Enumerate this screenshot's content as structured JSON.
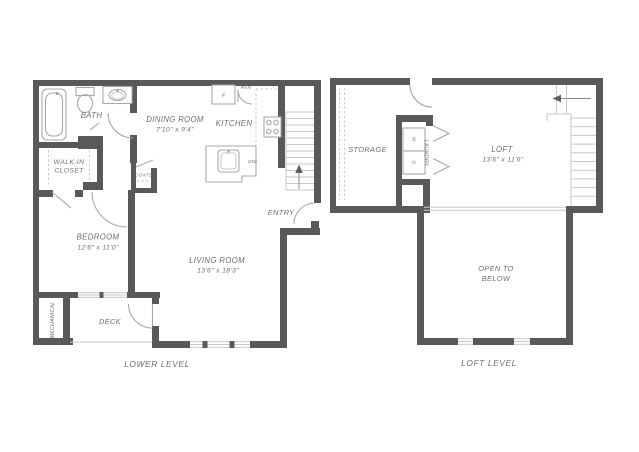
{
  "colors": {
    "wall": "#58595b",
    "line": "#a6a8ab",
    "tread": "#c6c7c9",
    "dash": "#c9cacc",
    "text": "#6e6f72",
    "bg": "#ffffff"
  },
  "lower_level": {
    "title": "LOWER LEVEL",
    "rooms": {
      "bath": {
        "name": "BATH"
      },
      "walk_in_closet": {
        "line1": "WALK-IN",
        "line2": "CLOSET"
      },
      "dining": {
        "name": "DINING ROOM",
        "dims": "7'10\" x 9'4\""
      },
      "kitchen": {
        "name": "KITCHEN"
      },
      "coats": {
        "name": "COATS"
      },
      "entry": {
        "name": "ENTRY"
      },
      "bedroom": {
        "name": "BEDROOM",
        "dims": "12'6\" x 11'0\""
      },
      "living": {
        "name": "LIVING ROOM",
        "dims": "13'6\" x 18'3\""
      },
      "deck": {
        "name": "DECK"
      },
      "mechanical": {
        "name": "MECHANICAL"
      }
    },
    "fixtures": {
      "fridge": "F",
      "pantry": "PAN",
      "dishwasher": "DW"
    }
  },
  "loft_level": {
    "title": "LOFT LEVEL",
    "rooms": {
      "storage": {
        "name": "STORAGE"
      },
      "laundry": {
        "name": "LAUNDRY",
        "washer": "W",
        "dryer": "D"
      },
      "loft": {
        "name": "LOFT",
        "dims": "13'6\" x 11'6\""
      },
      "open_to_below": {
        "line1": "OPEN TO",
        "line2": "BELOW"
      }
    }
  }
}
